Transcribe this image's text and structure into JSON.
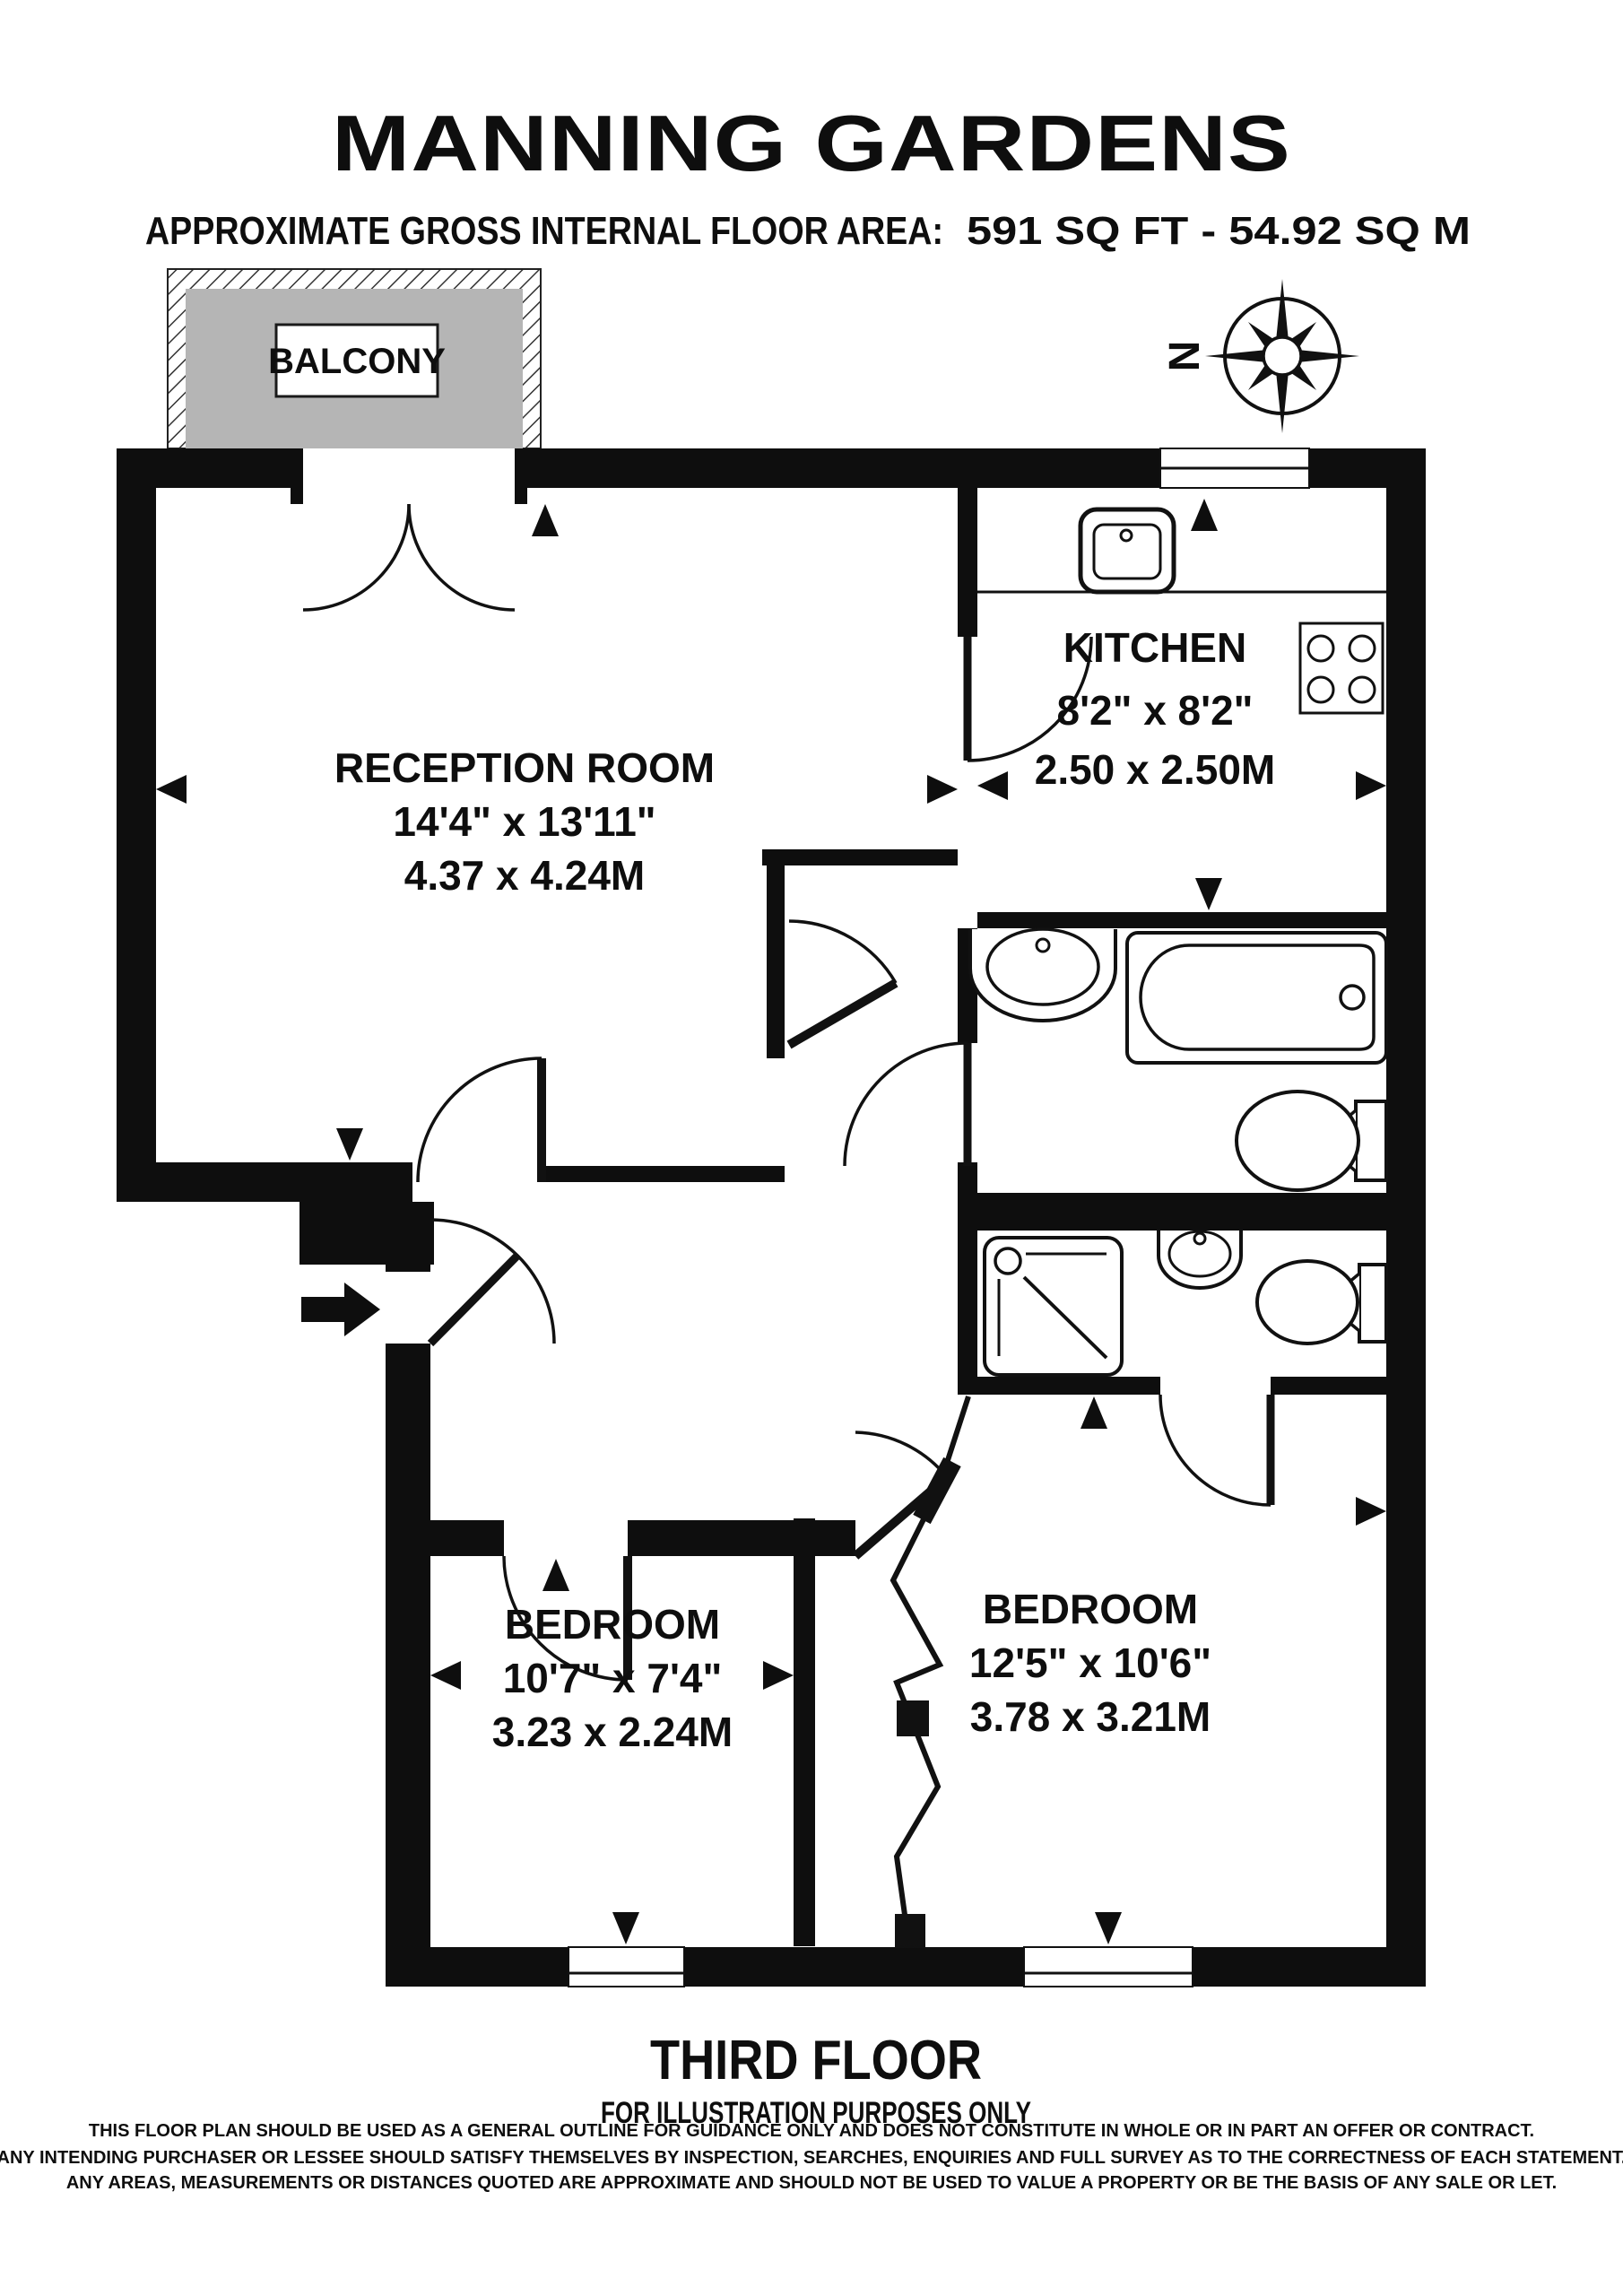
{
  "title": "MANNING GARDENS",
  "subtitle": {
    "label": "APPROXIMATE GROSS INTERNAL FLOOR AREA:",
    "value": "591 SQ FT - 54.92 SQ M"
  },
  "balcony_label": "BALCONY",
  "compass_north": "N",
  "rooms": {
    "reception": {
      "name": "RECEPTION ROOM",
      "imperial": "14'4\" x 13'11\"",
      "metric": "4.37 x 4.24M"
    },
    "kitchen": {
      "name": "KITCHEN",
      "imperial": "8'2\" x 8'2\"",
      "metric": "2.50 x 2.50M"
    },
    "bedroom_left": {
      "name": "BEDROOM",
      "imperial": "10'7\" x 7'4\"",
      "metric": "3.23 x 2.24M"
    },
    "bedroom_right": {
      "name": "BEDROOM",
      "imperial": "12'5\" x 10'6\"",
      "metric": "3.78 x 3.21M"
    }
  },
  "footer": {
    "floor_label": "THIRD FLOOR",
    "note": "FOR ILLUSTRATION PURPOSES ONLY",
    "disclaimer": [
      "THIS FLOOR PLAN SHOULD BE USED AS A GENERAL OUTLINE FOR GUIDANCE ONLY AND DOES NOT CONSTITUTE IN WHOLE OR IN PART AN OFFER OR CONTRACT.",
      "ANY INTENDING PURCHASER OR LESSEE SHOULD SATISFY THEMSELVES BY INSPECTION, SEARCHES, ENQUIRIES AND FULL SURVEY AS TO THE CORRECTNESS OF EACH STATEMENT.",
      "ANY AREAS, MEASUREMENTS OR DISTANCES QUOTED ARE APPROXIMATE AND SHOULD NOT BE USED TO VALUE A PROPERTY OR BE THE BASIS OF ANY SALE OR LET."
    ]
  },
  "colors": {
    "wall": "#0e0e0e",
    "balcony_fill": "#b5b5b5"
  }
}
